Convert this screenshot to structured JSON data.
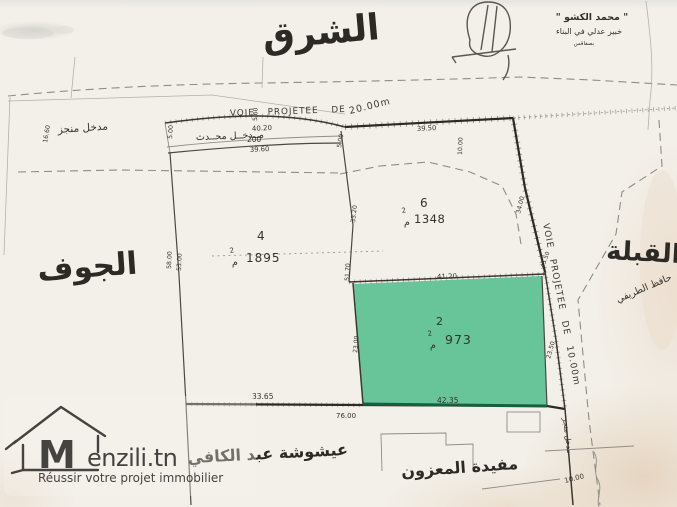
{
  "compass": {
    "top": "الشرق",
    "left": "الجوف",
    "right": "القبلة"
  },
  "stamp": {
    "name": "\" محمد الكشو \"",
    "title": "خبير عدلي في البناء",
    "place": "بصفاقس"
  },
  "roads": {
    "top_label": "VOIE PROJETEE DE",
    "top_width": "20.00m",
    "side_label": "VOIE PROJETEE DE 10.00m"
  },
  "entrances": {
    "left": "مدخل منجز",
    "top": "مــدخــل محــدث",
    "bottom": "مدخل منجز"
  },
  "neighbors": {
    "right": "حافظ الطريفي",
    "bottom_left": "عيشوشة عبد الكافي",
    "bottom_center": "مفيدة المعزون"
  },
  "plots": {
    "p4": {
      "number": "4",
      "area": "1895",
      "unit": "م",
      "unit_sup": "2"
    },
    "p6": {
      "number": "6",
      "area": "1348",
      "unit": "م",
      "unit_sup": "2"
    },
    "p2": {
      "number": "2",
      "area": "973",
      "unit": "م",
      "unit_sup": "2",
      "highlighted": true
    }
  },
  "measurements": {
    "m1660": "16.60",
    "m560": "5.60",
    "m4020": "40.20",
    "m200": "200",
    "m3960": "39.60",
    "m500a": "5.00",
    "m500b": "5.00",
    "m3950": "39.50",
    "m1000top": "10.00",
    "m3320": "33.20",
    "m5170": "51.70",
    "m3400": "34.00",
    "m4550": "45.50",
    "m4120": "41.20",
    "m5800": "58.00",
    "m5300": "53.00",
    "m2300": "23.00",
    "m2350": "23.50",
    "m4235": "42.35",
    "m7600": "76.00",
    "m3365": "33.65",
    "m1000br": "10.00"
  },
  "logo": {
    "m": "M",
    "brand": "enzili.tn",
    "tagline": "Réussir votre projet immobilier"
  },
  "colors": {
    "paper": "#f3f0e9",
    "ink": "#35332d",
    "highlight": "#5fc295",
    "highlight_edge": "#17603f",
    "logo": "#454340"
  }
}
